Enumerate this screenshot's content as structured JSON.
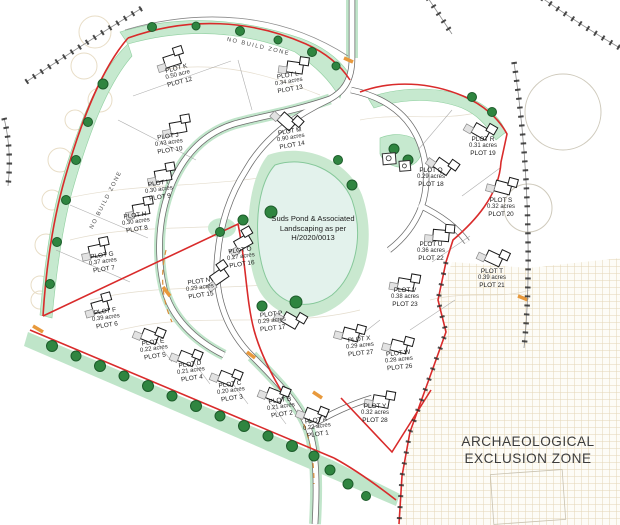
{
  "canvas": {
    "width": 620,
    "height": 525
  },
  "colors": {
    "boundary_red": "#d92b2b",
    "landscape_green": "#c6e9cf",
    "tree_green": "#2f8540",
    "pond_fill": "#e3f2ec",
    "hatch_tan": "#e3d5b5",
    "orange_marking": "#e8993c"
  },
  "pond": {
    "label_lines": [
      "Suds Pond & Associated",
      "Landscaping as per",
      "H/2020/0013"
    ]
  },
  "zones": {
    "archaeological": [
      "ARCHAEOLOGICAL",
      "EXCLUSION ZONE"
    ],
    "no_build_top": "NO BUILD ZONE",
    "no_build_left": "NO BUILD ZONE"
  },
  "plots": [
    {
      "label": "PLOT K",
      "acreage": "0.50 acre",
      "number": "PLOT 12",
      "x": 178,
      "y": 76,
      "rot": -14,
      "hx": 172,
      "hy": 60,
      "hrot": -18
    },
    {
      "label": "PLOT L",
      "acreage": "0.34 acres",
      "number": "PLOT 13",
      "x": 289,
      "y": 83,
      "rot": -10,
      "hx": 295,
      "hy": 67,
      "hrot": 8
    },
    {
      "label": "PLOT M",
      "acreage": "0.90 acres",
      "number": "PLOT 14",
      "x": 291,
      "y": 139,
      "rot": -10,
      "hx": 287,
      "hy": 121,
      "hrot": 42
    },
    {
      "label": "PLOT J",
      "acreage": "0.43 acres",
      "number": "PLOT 10",
      "x": 169,
      "y": 144,
      "rot": -8,
      "hx": 178,
      "hy": 127,
      "hrot": -10
    },
    {
      "label": "PLOT I",
      "acreage": "0.30 acres",
      "number": "PLOT 9",
      "x": 159,
      "y": 191,
      "rot": -8,
      "hx": 163,
      "hy": 175,
      "hrot": -10
    },
    {
      "label": "PLOT H",
      "acreage": "0.30 acres",
      "number": "PLOT 8",
      "x": 136,
      "y": 223,
      "rot": -8,
      "hx": 141,
      "hy": 209,
      "hrot": -10
    },
    {
      "label": "PLOT G",
      "acreage": "0.37 acres",
      "number": "PLOT 7",
      "x": 103,
      "y": 263,
      "rot": -8,
      "hx": 97,
      "hy": 250,
      "hrot": -12
    },
    {
      "label": "PLOT F",
      "acreage": "0.39 acres",
      "number": "PLOT 6",
      "x": 106,
      "y": 319,
      "rot": -8,
      "hx": 100,
      "hy": 306,
      "hrot": -16
    },
    {
      "label": "PLOT E",
      "acreage": "0.22 acres",
      "number": "PLOT 5",
      "x": 154,
      "y": 350,
      "rot": -8,
      "hx": 150,
      "hy": 336,
      "hrot": 22
    },
    {
      "label": "PLOT D",
      "acreage": "0.21 acres",
      "number": "PLOT 4",
      "x": 191,
      "y": 372,
      "rot": -8,
      "hx": 187,
      "hy": 358,
      "hrot": 22
    },
    {
      "label": "PLOT C",
      "acreage": "0.20 acres",
      "number": "PLOT 3",
      "x": 231,
      "y": 392,
      "rot": -8,
      "hx": 227,
      "hy": 378,
      "hrot": 22
    },
    {
      "label": "PLOT B",
      "acreage": "0.21 acres",
      "number": "PLOT 2",
      "x": 281,
      "y": 408,
      "rot": -8,
      "hx": 275,
      "hy": 395,
      "hrot": 22
    },
    {
      "label": "PLOT A",
      "acreage": "0.22 acres",
      "number": "PLOT 1",
      "x": 317,
      "y": 428,
      "rot": -8,
      "hx": 313,
      "hy": 415,
      "hrot": 22
    },
    {
      "label": "PLOT N",
      "acreage": "0.29 acres",
      "number": "PLOT 15",
      "x": 200,
      "y": 289,
      "rot": -8,
      "hx": 219,
      "hy": 276,
      "hrot": -35
    },
    {
      "label": "PLOT O",
      "acreage": "0.27 acres",
      "number": "PLOT 16",
      "x": 241,
      "y": 258,
      "rot": -8,
      "hx": 243,
      "hy": 242,
      "hrot": -30
    },
    {
      "label": "PLOT P",
      "acreage": "0.29 acres",
      "number": "PLOT 17",
      "x": 272,
      "y": 322,
      "rot": -6,
      "hx": 291,
      "hy": 320,
      "hrot": 30
    },
    {
      "label": "PLOT Q",
      "acreage": "0.29 acres",
      "number": "PLOT 18",
      "x": 431,
      "y": 178,
      "rot": 0,
      "hx": 443,
      "hy": 166,
      "hrot": 35
    },
    {
      "label": "PLOT R",
      "acreage": "0.31 acres",
      "number": "PLOT 19",
      "x": 483,
      "y": 147,
      "rot": 0,
      "hx": 481,
      "hy": 131,
      "hrot": 30
    },
    {
      "label": "PLOT S",
      "acreage": "0.32 acres",
      "number": "PLOT 20",
      "x": 501,
      "y": 208,
      "rot": 0,
      "hx": 503,
      "hy": 187,
      "hrot": 15
    },
    {
      "label": "PLOT T",
      "acreage": "0.39 acres",
      "number": "PLOT 21",
      "x": 492,
      "y": 279,
      "rot": 0,
      "hx": 494,
      "hy": 258,
      "hrot": 25
    },
    {
      "label": "PLOT U",
      "acreage": "0.36 acres",
      "number": "PLOT 22",
      "x": 431,
      "y": 252,
      "rot": 0,
      "hx": 441,
      "hy": 235,
      "hrot": 5
    },
    {
      "label": "PLOT V",
      "acreage": "0.38 acres",
      "number": "PLOT 23",
      "x": 405,
      "y": 298,
      "rot": 0,
      "hx": 406,
      "hy": 284,
      "hrot": 10
    },
    {
      "label": "PLOT X",
      "acreage": "0.29 acres",
      "number": "PLOT 27",
      "x": 360,
      "y": 347,
      "rot": -6,
      "hx": 351,
      "hy": 334,
      "hrot": 15
    },
    {
      "label": "PLOT W",
      "acreage": "0.28 acres",
      "number": "PLOT 26",
      "x": 399,
      "y": 361,
      "rot": -6,
      "hx": 399,
      "hy": 346,
      "hrot": 15
    },
    {
      "label": "PLOT Y",
      "acreage": "0.32 acres",
      "number": "PLOT 28",
      "x": 375,
      "y": 414,
      "rot": 0,
      "hx": 381,
      "hy": 401,
      "hrot": 10
    }
  ]
}
